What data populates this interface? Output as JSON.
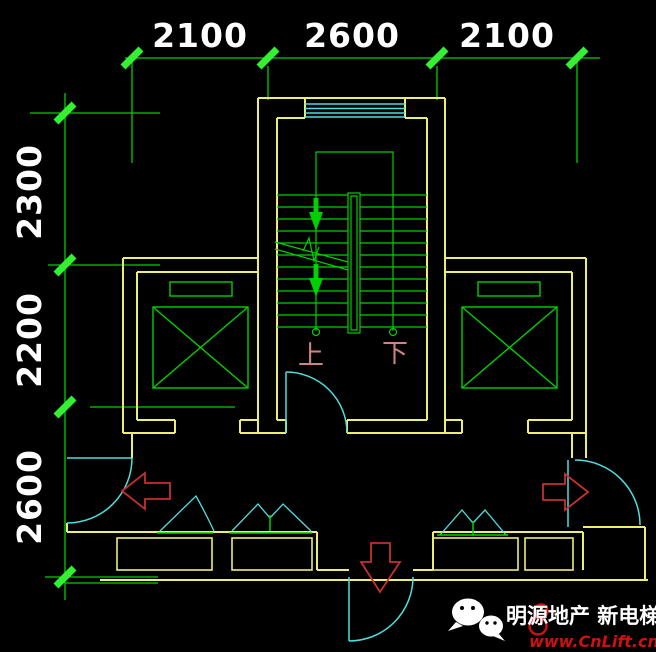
{
  "drawing": {
    "type": "stair-elevator-core-floor-plan",
    "dim_top": [
      "2100",
      "2600",
      "2100"
    ],
    "dim_left": [
      "2300",
      "2200",
      "2600"
    ],
    "stair_up_label": "上",
    "stair_down_label": "下"
  },
  "watermark": {
    "brand": "明源地产 新电梯",
    "url": "www.CnLift.cn",
    "icon": "wechat-icon"
  },
  "colors": {
    "background": "#000000",
    "wall_yellow": "#eded72",
    "drawing_green": "#00cf00",
    "dimension_tick_green": "#33f033",
    "glazing_cyan": "#4fdede",
    "arrow_red": "#c53030",
    "stair_label_salmon": "#cf8383",
    "dimension_text": "#ffffff",
    "watermark_red": "#cc1111"
  }
}
